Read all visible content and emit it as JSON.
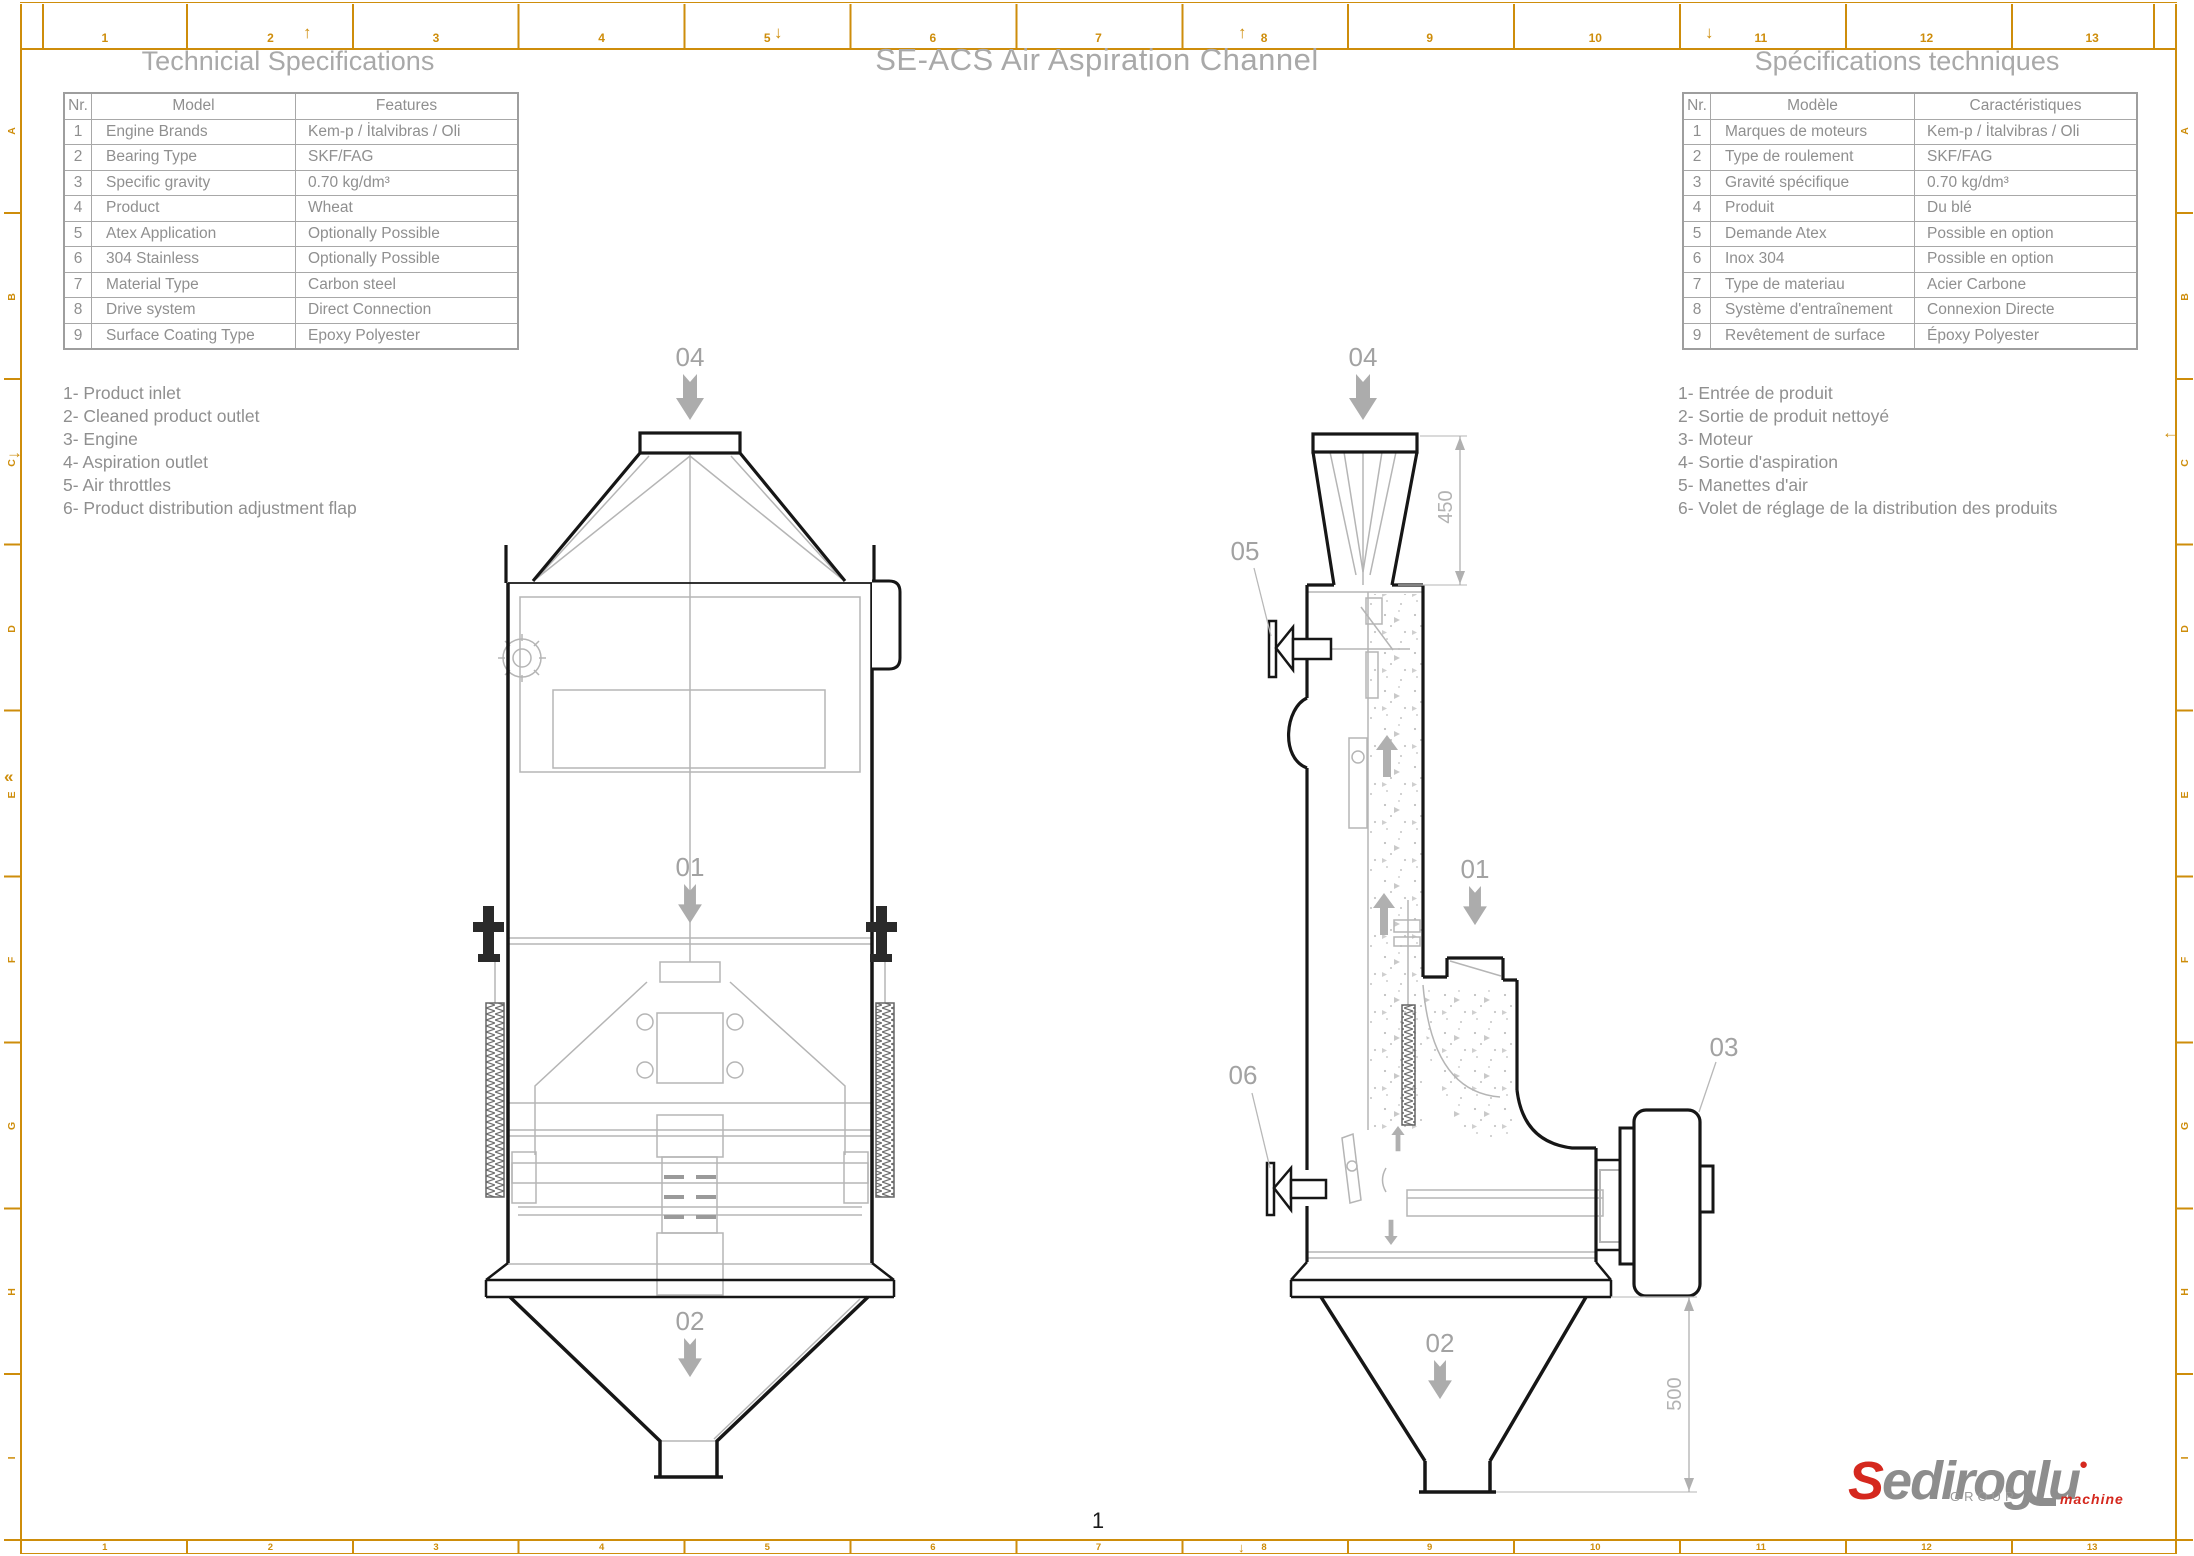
{
  "page": {
    "title": "SE-ACS Air Aspiration Channel",
    "number": "1"
  },
  "spec_table_en": {
    "title": "Technicial Specifications",
    "headers": [
      "Nr.",
      "Model",
      "Features"
    ],
    "rows": [
      [
        "1",
        "Engine Brands",
        "Kem-p / İtalvibras / Oli"
      ],
      [
        "2",
        "Bearing Type",
        "SKF/FAG"
      ],
      [
        "3",
        "Specific gravity",
        "0.70 kg/dm³"
      ],
      [
        "4",
        "Product",
        "Wheat"
      ],
      [
        "5",
        "Atex Application",
        "Optionally Possible"
      ],
      [
        "6",
        "304 Stainless",
        "Optionally Possible"
      ],
      [
        "7",
        "Material Type",
        "Carbon steel"
      ],
      [
        "8",
        "Drive system",
        "Direct Connection"
      ],
      [
        "9",
        "Surface Coating Type",
        "Epoxy Polyester"
      ]
    ]
  },
  "spec_table_fr": {
    "title": "Spécifications techniques",
    "headers": [
      "Nr.",
      "Modèle",
      "Caractéristiques"
    ],
    "rows": [
      [
        "1",
        "Marques de moteurs",
        "Kem-p / İtalvibras / Oli"
      ],
      [
        "2",
        "Type de roulement",
        "SKF/FAG"
      ],
      [
        "3",
        "Gravité spécifique",
        "0.70 kg/dm³"
      ],
      [
        "4",
        "Produit",
        "Du blé"
      ],
      [
        "5",
        "Demande Atex",
        "Possible en option"
      ],
      [
        "6",
        "Inox 304",
        "Possible en option"
      ],
      [
        "7",
        "Type de materiau",
        "Acier Carbone"
      ],
      [
        "8",
        "Système d'entraînement",
        "Connexion Directe"
      ],
      [
        "9",
        "Revêtement de surface",
        "Époxy Polyester"
      ]
    ]
  },
  "legend_en": {
    "items": [
      "1- Product inlet",
      "2- Cleaned product outlet",
      "3- Engine",
      "4- Aspiration outlet",
      "5- Air throttles",
      "6- Product distribution adjustment flap"
    ]
  },
  "legend_fr": {
    "items": [
      "1- Entrée de produit",
      "2- Sortie de produit nettoyé",
      "3- Moteur",
      "4- Sortie d'aspiration",
      "5- Manettes d'air",
      "6- Volet de réglage de la distribution des produits"
    ]
  },
  "drawing": {
    "front": {
      "label_04": "04",
      "label_01": "01",
      "label_02": "02"
    },
    "side": {
      "label_04": "04",
      "label_05": "05",
      "label_01": "01",
      "label_06": "06",
      "label_03": "03",
      "label_02": "02"
    },
    "dims": {
      "hood_height": "450",
      "cone_height": "500"
    }
  },
  "frame": {
    "columns": [
      "1",
      "2",
      "3",
      "4",
      "5",
      "6",
      "7",
      "8",
      "9",
      "10",
      "11",
      "12",
      "13"
    ],
    "rows": [
      "A",
      "B",
      "C",
      "D",
      "E",
      "F",
      "G",
      "H",
      "I"
    ],
    "marks": {
      "up": "↑",
      "down": "↓",
      "left": "←",
      "right": "→",
      "double_left": "«"
    }
  },
  "logo": {
    "initial": "S",
    "rest": "ediroglu",
    "group": "GROUP",
    "machine": "machine"
  },
  "colors": {
    "frame": "#CE8D0B",
    "drawing_dark": "#161616",
    "drawing_gray": "#b5b5b5",
    "label_gray": "#a2a2a2",
    "logo_red": "#D5281E",
    "logo_gray": "#8D8D8D"
  }
}
